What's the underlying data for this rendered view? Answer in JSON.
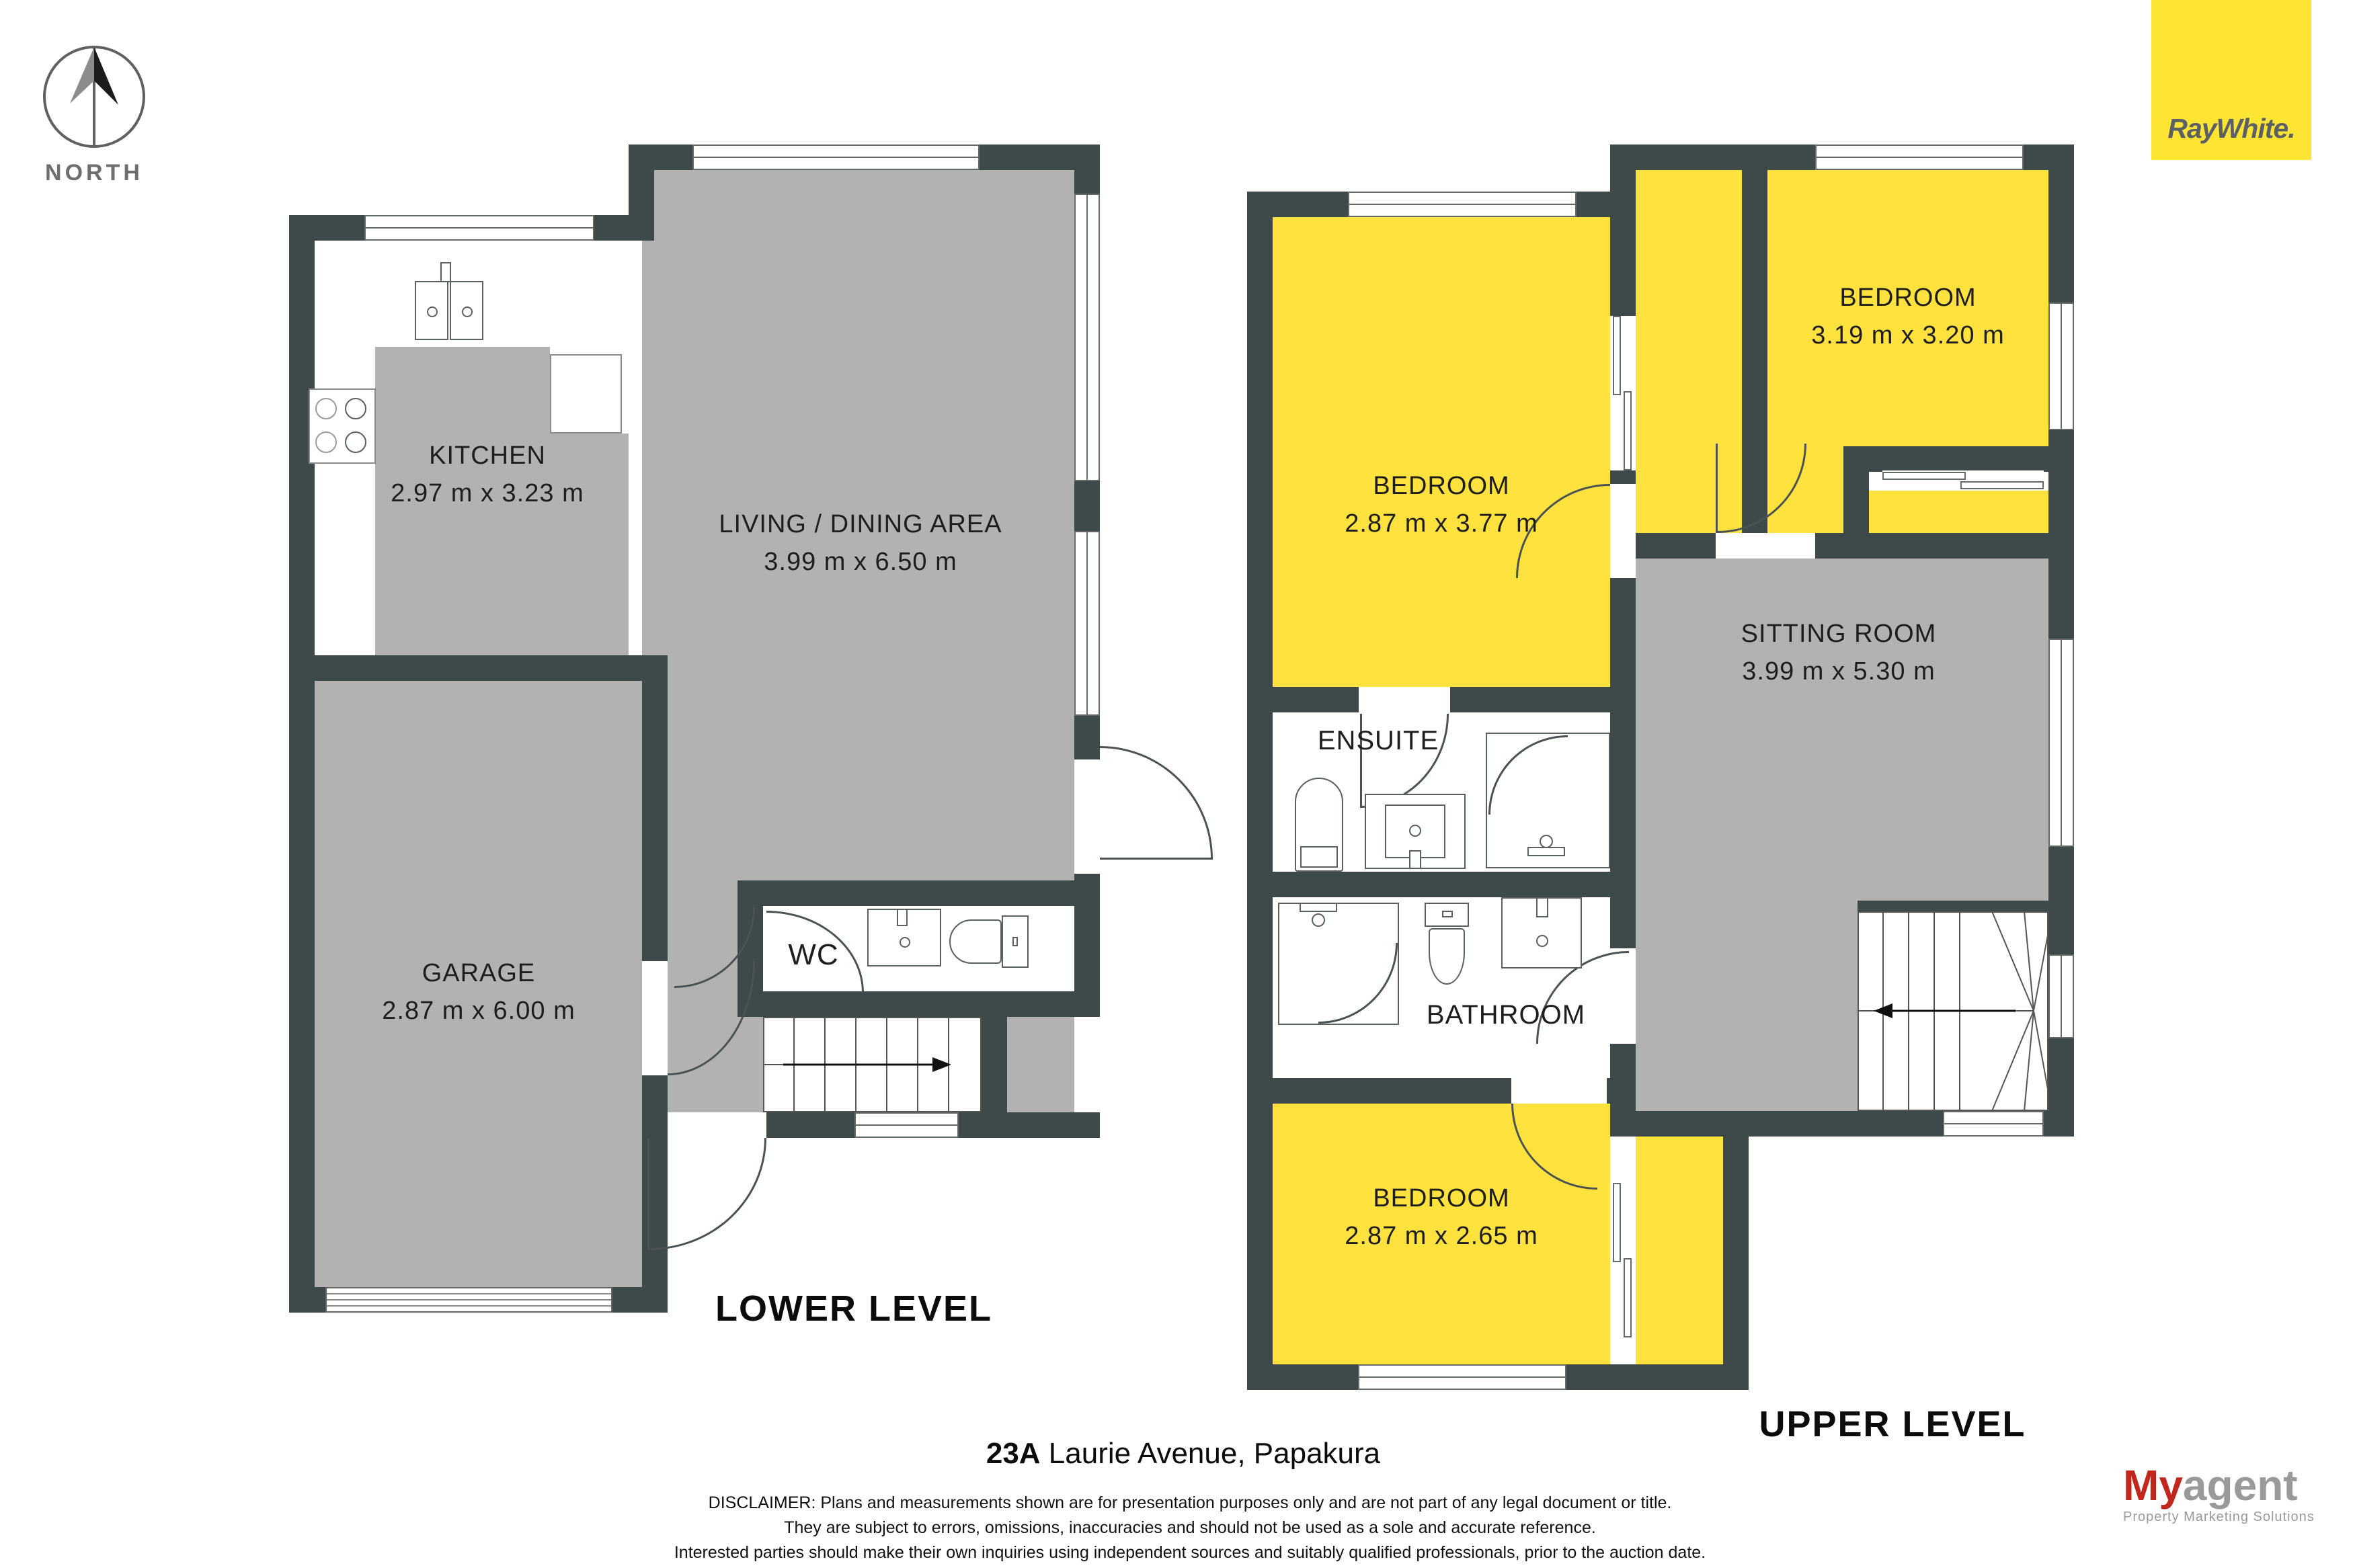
{
  "compass": {
    "label": "NORTH"
  },
  "brand": {
    "logo_text": "RayWhite.",
    "box_color": "#FFE533",
    "text_color": "#5B5F66"
  },
  "colors": {
    "wall": "#3E4949",
    "floor_gray": "#B2B2B2",
    "room_yellow": "#FFE23E",
    "agency_red": "#C1271D",
    "agency_gray": "#9a9a9a"
  },
  "lower": {
    "title": "LOWER LEVEL",
    "rooms": {
      "kitchen": {
        "name": "KITCHEN",
        "dims": "2.97 m x 3.23 m"
      },
      "living": {
        "name": "LIVING / DINING AREA",
        "dims": "3.99 m x 6.50 m"
      },
      "garage": {
        "name": "GARAGE",
        "dims": "2.87 m x 6.00 m"
      },
      "wc": {
        "name": "WC"
      }
    }
  },
  "upper": {
    "title": "UPPER LEVEL",
    "rooms": {
      "bedroom1": {
        "name": "BEDROOM",
        "dims": "2.87 m x 3.77 m"
      },
      "bedroom2": {
        "name": "BEDROOM",
        "dims": "3.19 m x 3.20 m"
      },
      "sitting": {
        "name": "SITTING ROOM",
        "dims": "3.99 m x 5.30 m"
      },
      "ensuite": {
        "name": "ENSUITE"
      },
      "bathroom": {
        "name": "BATHROOM"
      },
      "bedroom3": {
        "name": "BEDROOM",
        "dims": "2.87 m x 2.65 m"
      }
    }
  },
  "footer": {
    "address_number": "23A",
    "address_rest": " Laurie Avenue, Papakura",
    "disclaimer_lines": [
      "DISCLAIMER: Plans and measurements shown are for presentation purposes only and are not part of any legal document or title.",
      "They are subject to errors, omissions, inaccuracies and should not be used as a sole and accurate reference.",
      "Interested parties should make their own inquiries using independent sources and suitably qualified professionals, prior to the auction date."
    ]
  },
  "agency": {
    "brand_my": "My",
    "brand_agent": "agent",
    "tagline": "Property Marketing Solutions"
  }
}
